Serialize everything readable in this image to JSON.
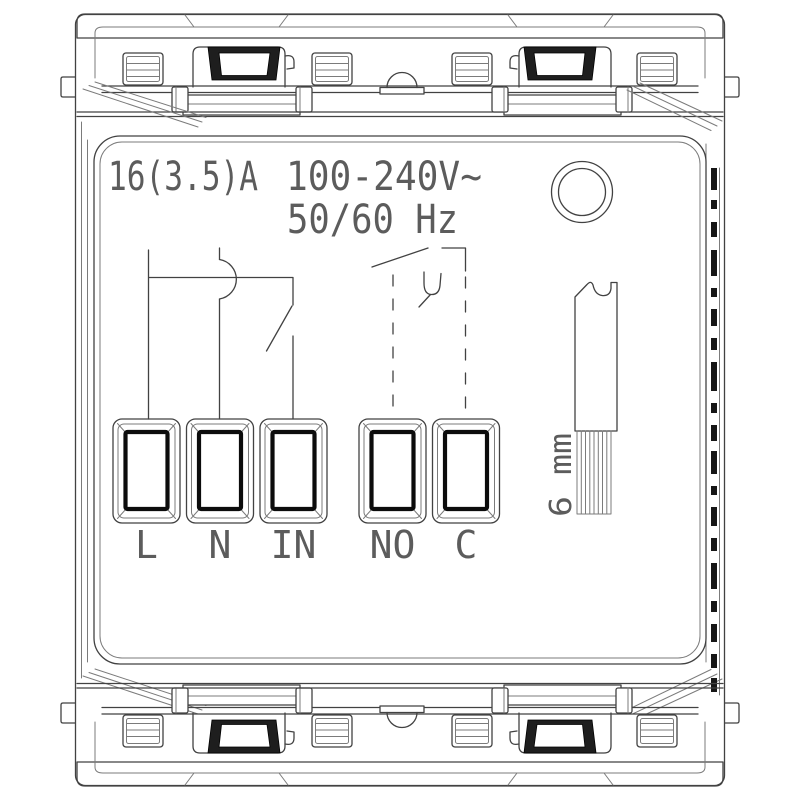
{
  "ratings": {
    "current": "16(3.5)A",
    "voltage": "100-240V~",
    "frequency": "50/60 Hz"
  },
  "terminals": [
    {
      "label": "L"
    },
    {
      "label": "N"
    },
    {
      "label": "IN"
    },
    {
      "label": "NO"
    },
    {
      "label": "C"
    }
  ],
  "wire_strip": {
    "length_label": "6 mm"
  },
  "symbols": {
    "indicator": "indicator-circle-icon",
    "input_circuit": "switch-contact-symbol",
    "output_circuit": "relay-no-contact-symbol",
    "wire": "stripped-wire-icon",
    "mounting": "mounting-clip"
  },
  "colors": {
    "background": "#ffffff",
    "line": "#424242",
    "light_line": "#7b7b7b",
    "dark_fill": "#1e1e1e",
    "text": "#5c5c5c"
  }
}
